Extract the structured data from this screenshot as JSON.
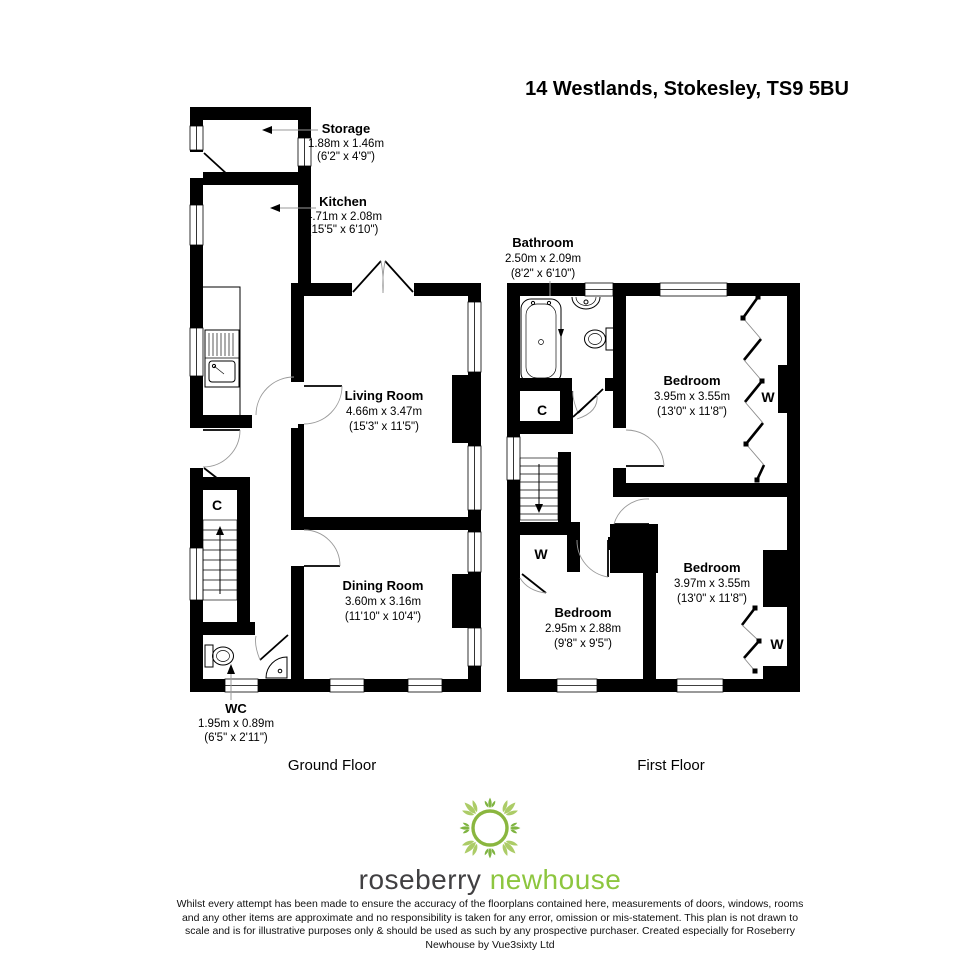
{
  "title": "14 Westlands, Stokesley, TS9 5BU",
  "ground_floor": {
    "label": "Ground Floor",
    "storage": {
      "name": "Storage",
      "metric": "1.88m x 1.46m",
      "imperial": "(6'2\" x 4'9\")"
    },
    "kitchen": {
      "name": "Kitchen",
      "metric": "4.71m x 2.08m",
      "imperial": "(15'5\" x 6'10\")"
    },
    "living": {
      "name": "Living Room",
      "metric": "4.66m x 3.47m",
      "imperial": "(15'3\" x 11'5\")"
    },
    "dining": {
      "name": "Dining Room",
      "metric": "3.60m x 3.16m",
      "imperial": "(11'10\" x 10'4\")"
    },
    "wc": {
      "name": "WC",
      "metric": "1.95m x 0.89m",
      "imperial": "(6'5\" x 2'11\")"
    },
    "cupboard": "C"
  },
  "first_floor": {
    "label": "First Floor",
    "bathroom": {
      "name": "Bathroom",
      "metric": "2.50m x 2.09m",
      "imperial": "(8'2\" x 6'10\")"
    },
    "bedroom1": {
      "name": "Bedroom",
      "metric": "3.95m x 3.55m",
      "imperial": "(13'0\" x 11'8\")"
    },
    "bedroom2": {
      "name": "Bedroom",
      "metric": "3.97m x 3.55m",
      "imperial": "(13'0\" x 11'8\")"
    },
    "bedroom3": {
      "name": "Bedroom",
      "metric": "2.95m x 2.88m",
      "imperial": "(9'8\" x 9'5\")"
    },
    "cupboard": "C",
    "wardrobe": "W"
  },
  "logo": {
    "primary": "roseberry",
    "secondary": "newhouse",
    "primary_color": "#414042",
    "secondary_color": "#8dc63f",
    "ornament_light": "#accc67",
    "ornament_dark": "#7fb441"
  },
  "disclaimer": "Whilst every attempt has been made to ensure the accuracy of the floorplans contained here, measurements of doors, windows, rooms and any other items are approximate and no responsibility is taken for any error, omission or mis-statement. This plan is not drawn to scale and is for illustrative purposes only & should be used as such by any prospective purchaser. Created especially for Roseberry Newhouse by Vue3sixty Ltd"
}
